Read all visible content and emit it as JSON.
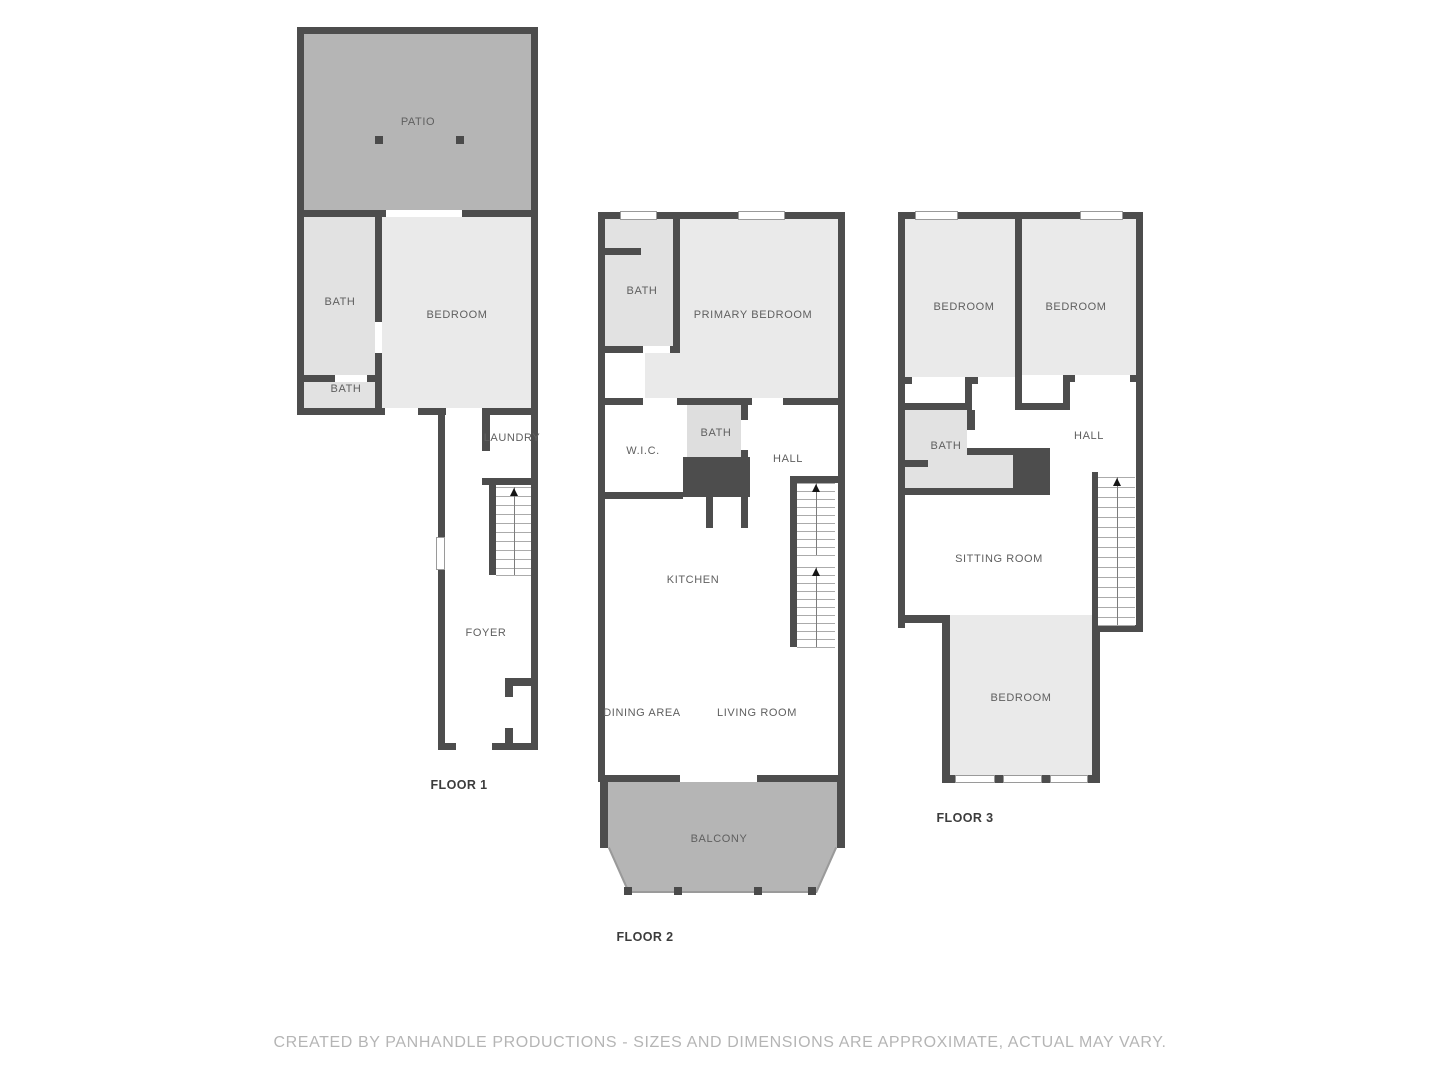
{
  "footer": {
    "text": "CREATED BY PANHANDLE PRODUCTIONS - SIZES AND DIMENSIONS ARE APPROXIMATE, ACTUAL MAY VARY."
  },
  "colors": {
    "wall": "#4d4d4d",
    "outdoor_fill": "#b5b5b5",
    "room_fill": "#eaeaea",
    "bath_fill": "#e2e2e2",
    "label_text": "#5f5f5f",
    "footer_text": "#b5b5b5"
  },
  "floor1": {
    "label": "FLOOR 1",
    "rooms": {
      "patio": "PATIO",
      "bath_upper": "BATH",
      "bath_lower": "BATH",
      "bedroom": "BEDROOM",
      "laundry": "LAUNDRY",
      "foyer": "FOYER"
    }
  },
  "floor2": {
    "label": "FLOOR 2",
    "rooms": {
      "bath": "BATH",
      "primary_bedroom": "PRIMARY BEDROOM",
      "wic": "W.I.C.",
      "bath2": "BATH",
      "hall": "HALL",
      "kitchen": "KITCHEN",
      "dining_area": "DINING AREA",
      "living_room": "LIVING ROOM",
      "balcony": "BALCONY"
    }
  },
  "floor3": {
    "label": "FLOOR 3",
    "rooms": {
      "bedroom_left": "BEDROOM",
      "bedroom_right": "BEDROOM",
      "bath": "BATH",
      "hall": "HALL",
      "sitting_room": "SITTING ROOM",
      "bedroom_lower": "BEDROOM"
    }
  }
}
